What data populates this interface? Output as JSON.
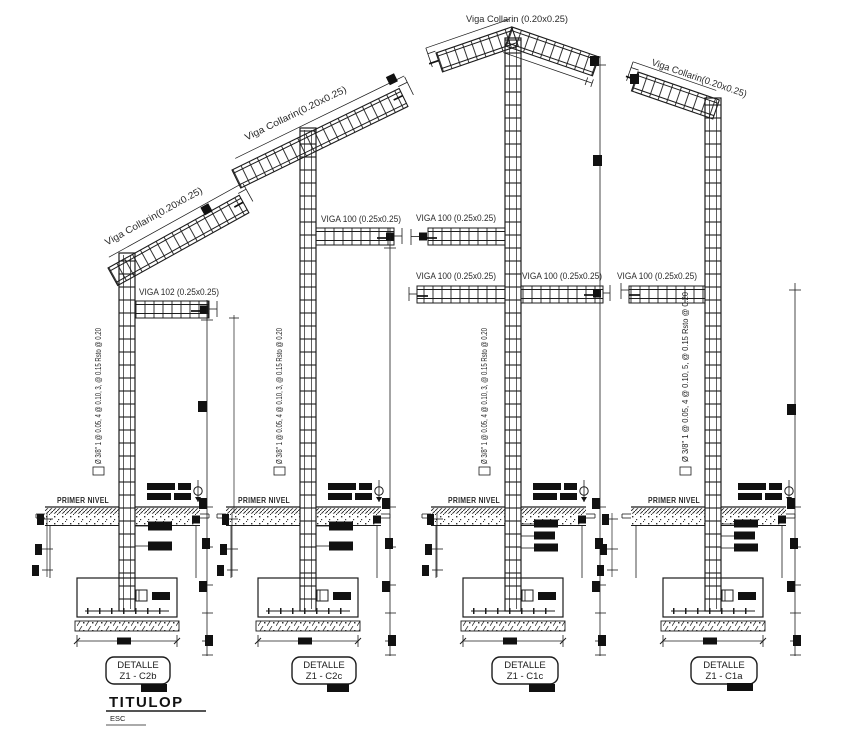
{
  "drawing": {
    "colors": {
      "line": "#1c1c1c",
      "text": "#2b2b2b",
      "background": "#ffffff"
    },
    "footer": {
      "title": "TITULOP",
      "scale_label": "ESC"
    },
    "details": [
      {
        "box_title": "DETALLE",
        "code": "Z1 - C2b",
        "collar_beam": "Viga Collarin(0.20x0.25)",
        "beam": "VIGA 102 (0.25x0.25)",
        "stirrup_note": "Ø 3/8\" 1 @ 0.05, 4 @ 0.10, 3, @ 0.15 Rsto @ 0.20",
        "level": "PRIMER NIVEL"
      },
      {
        "box_title": "DETALLE",
        "code": "Z1 - C2c",
        "collar_beam": "Viga Collarin(0.20x0.25)",
        "beam": "VIGA 100 (0.25x0.25)",
        "stirrup_note": "Ø 3/8\" 1 @ 0.05, 4 @ 0.10, 3, @ 0.15 Rsto @ 0.20",
        "level": "PRIMER NIVEL"
      },
      {
        "box_title": "DETALLE",
        "code": "Z1 - C1c",
        "collar_beam": "Viga Collarin (0.20x0.25)",
        "beam_upper_left": "VIGA 100 (0.25x0.25)",
        "beam_lower_left": "VIGA 100 (0.25x0.25)",
        "beam_lower_right": "VIGA 100 (0.25x0.25)",
        "stirrup_note": "Ø 3/8\" 1 @ 0.05, 4 @ 0.10, 3, @ 0.15 Rsto @ 0.20",
        "level": "PRIMER NIVEL"
      },
      {
        "box_title": "DETALLE",
        "code": "Z1 - C1a",
        "collar_beam": "Viga Collarin(0.20x0.25)",
        "beam": "VIGA 100 (0.25x0.25)",
        "stirrup_note": "Ø 3/8\" 1 @ 0.05, 4 @ 0.10, 5, @ 0.15 Rsto @ 0.20",
        "level": "PRIMER NIVEL"
      }
    ]
  }
}
